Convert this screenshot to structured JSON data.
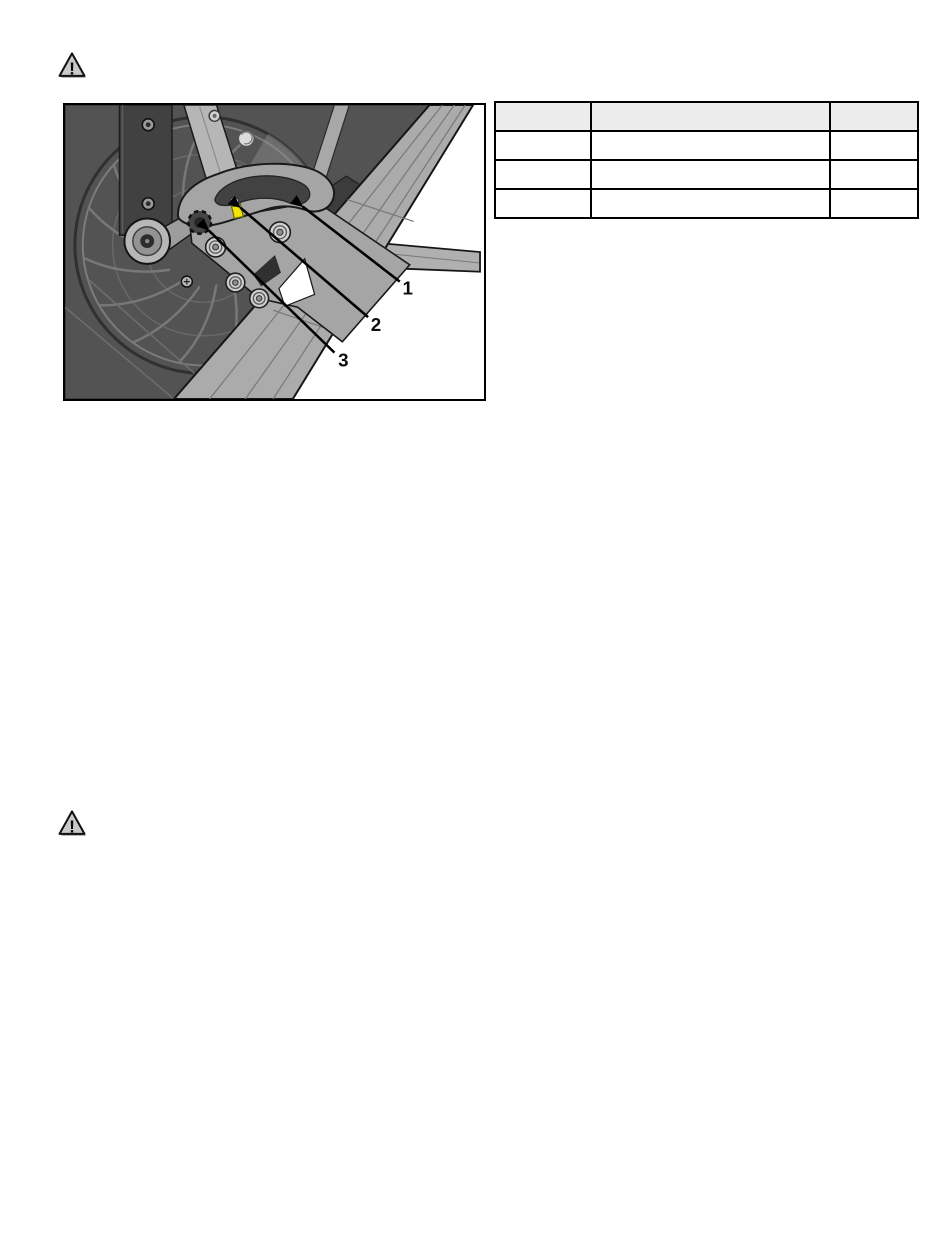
{
  "page": {
    "type": "manual-page",
    "background": "#ffffff"
  },
  "warning_icon_top": {
    "symbol": "!"
  },
  "warning_icon_bottom": {
    "symbol": "!"
  },
  "figure": {
    "kind": "technical-illustration",
    "border_color": "#000000",
    "highlight_color": "#f2e400",
    "callouts": [
      {
        "label": "1"
      },
      {
        "label": "2"
      },
      {
        "label": "3"
      }
    ]
  },
  "table": {
    "header_bg": "#ececec",
    "border_color": "#000000",
    "columns": [
      "",
      "",
      ""
    ],
    "rows": [
      [
        "",
        "",
        ""
      ],
      [
        "",
        "",
        ""
      ],
      [
        "",
        "",
        ""
      ]
    ]
  }
}
